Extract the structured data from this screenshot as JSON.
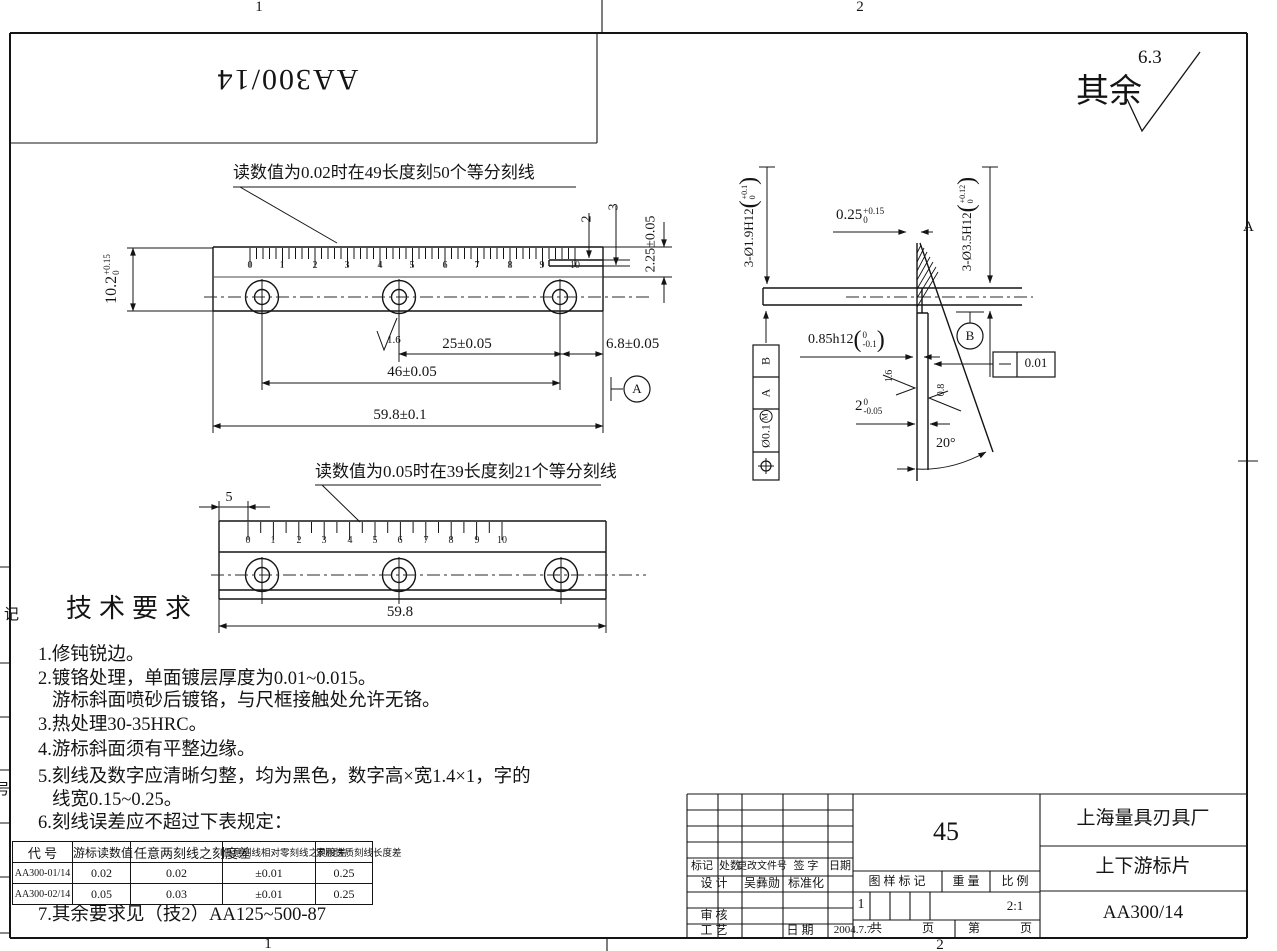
{
  "sheet": {
    "background": "#ffffff",
    "line_color": "#141414",
    "top_left_code": "AA300/14",
    "surface_default": {
      "prefix": "其余",
      "value": "6.3"
    },
    "zones": {
      "top_1": "1",
      "top_2": "2",
      "bottom_1": "1",
      "bottom_2": "2",
      "right_a": "A"
    },
    "left_edge_partial": {
      "upper": "记",
      "lower": "号"
    }
  },
  "glyphs": {
    "lp": "(",
    "rp": ")"
  },
  "view1": {
    "callout": "读数值为0.02时在49长度刻50个等分刻线",
    "numbers": [
      "0",
      "1",
      "2",
      "3",
      "4",
      "5",
      "6",
      "7",
      "8",
      "9",
      "10"
    ],
    "tick_count": 51,
    "dim_height": {
      "value": "10.2",
      "tol_up": "+0.15",
      "tol_dn": "0"
    },
    "dim_step2": "2",
    "dim_step3": "3",
    "dim_225": "2.25±0.05",
    "dim_25": "25±0.05",
    "dim_46": "46±0.05",
    "dim_68": "6.8±0.05",
    "dim_total": "59.8±0.1",
    "finish": "1.6",
    "datum": "A"
  },
  "view2": {
    "callout": "读数值为0.05时在39长度刻21个等分刻线",
    "numbers": [
      "0",
      "1",
      "2",
      "3",
      "4",
      "5",
      "6",
      "7",
      "8",
      "9",
      "10"
    ],
    "tick_count": 21,
    "dim_5": "5",
    "dim_total": "59.8"
  },
  "section": {
    "dim_holes_small": {
      "value": "3-Ø1.9H12",
      "tol_up": "+0.1",
      "tol_dn": "0"
    },
    "dim_holes_big": {
      "value": "3-Ø3.5H12",
      "tol_up": "+0.12",
      "tol_dn": "0"
    },
    "dim_tip": {
      "value": "0.25",
      "tol_up": "+0.15",
      "tol_dn": "0"
    },
    "dim_step": {
      "value": "0.85h12",
      "tol_up": "0",
      "tol_dn": "-0.1"
    },
    "dim_thickness": {
      "value": "2",
      "tol_up": "0",
      "tol_dn": "-0.05"
    },
    "angle": "20°",
    "finish_16": "1.6",
    "finish_08": "0.8",
    "datum": "B",
    "flatness": "0.01",
    "position": {
      "tol": "Ø0.1",
      "modifier": "M",
      "datum_a": "A",
      "datum_b": "B"
    }
  },
  "tech": {
    "title": "技术要求",
    "lines": [
      "1.修钝锐边。",
      "2.镀铬处理，单面镀层厚度为0.01~0.015。",
      "游标斜面喷砂后镀铬，与尺框接触处允许无铬。",
      "3.热处理30-35HRC。",
      "4.游标斜面须有平整边缘。",
      "5.刻线及数字应清晰匀整，均为黑色，数字高×宽1.4×1，字的",
      "线宽0.15~0.25。",
      "6.刻线误差应不超过下表规定：",
      "7.其余要求见（技2）AA125~500-87"
    ]
  },
  "table": {
    "headers": [
      "代 号",
      "游标读数值",
      "任意两刻线之刻度差",
      "任意刻线相对零刻线之刻度差",
      "累积性质刻线长度差"
    ],
    "rows": [
      [
        "AA300-01/14",
        "0.02",
        "0.02",
        "±0.01",
        "0.25"
      ],
      [
        "AA300-02/14",
        "0.05",
        "0.03",
        "±0.01",
        "0.25"
      ]
    ]
  },
  "title_block": {
    "company": "上海量具刃具厂",
    "part_name": "上下游标片",
    "drawing_no": "AA300/14",
    "material": "45",
    "scale_value": "2:1",
    "stamp_value": "1",
    "date_value": "2004.7.7",
    "designer": "吴彝勋",
    "labels": {
      "mark": "标记",
      "count": "处数",
      "change_doc": "更改文件号",
      "sign": "签 字",
      "date": "日期",
      "design": "设 计",
      "standardize": "标准化",
      "check": "审 核",
      "process": "工 艺",
      "date2": "日 期",
      "stamp": "图 样 标 记",
      "weight": "重 量",
      "scale": "比 例",
      "total": "共",
      "pages": "页",
      "no": "第",
      "page2": "页"
    }
  }
}
